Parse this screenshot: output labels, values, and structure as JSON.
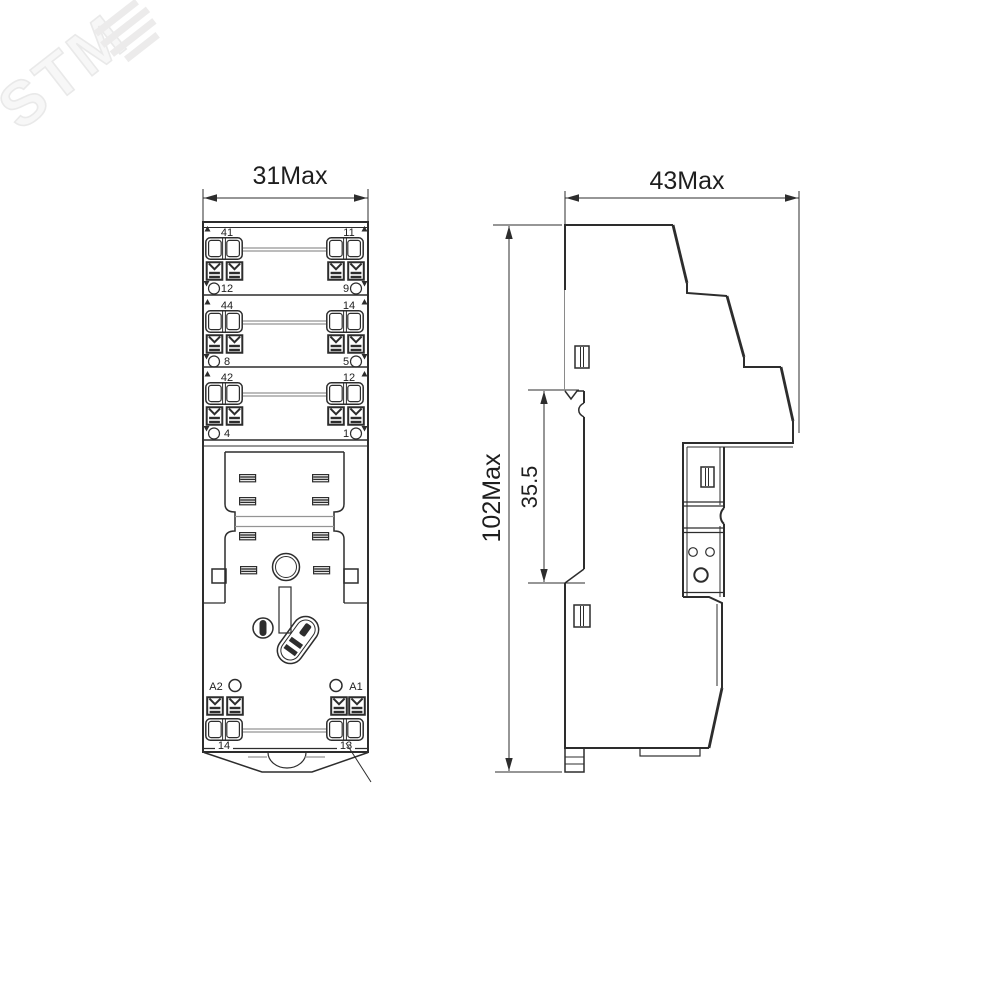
{
  "watermark": {
    "text": "STM"
  },
  "colors": {
    "line": "#2d2d2d",
    "thin_line": "#949494",
    "watermark": "#ececec",
    "background": "#ffffff"
  },
  "front_view": {
    "width_label": "31Max",
    "pole_rows": [
      {
        "top_left": "41",
        "top_right": "11",
        "bottom_left": "12",
        "bottom_right": "9"
      },
      {
        "top_left": "44",
        "top_right": "14",
        "bottom_left": "8",
        "bottom_right": "5"
      },
      {
        "top_left": "42",
        "top_right": "12",
        "bottom_left": "4",
        "bottom_right": "1"
      }
    ],
    "coil_terminals": {
      "left": "A2",
      "right": "A1",
      "bottom_left": "14",
      "bottom_right": "13"
    }
  },
  "side_view": {
    "depth_label": "43Max",
    "height_label": "102Max",
    "clip_distance_label": "35.5"
  }
}
